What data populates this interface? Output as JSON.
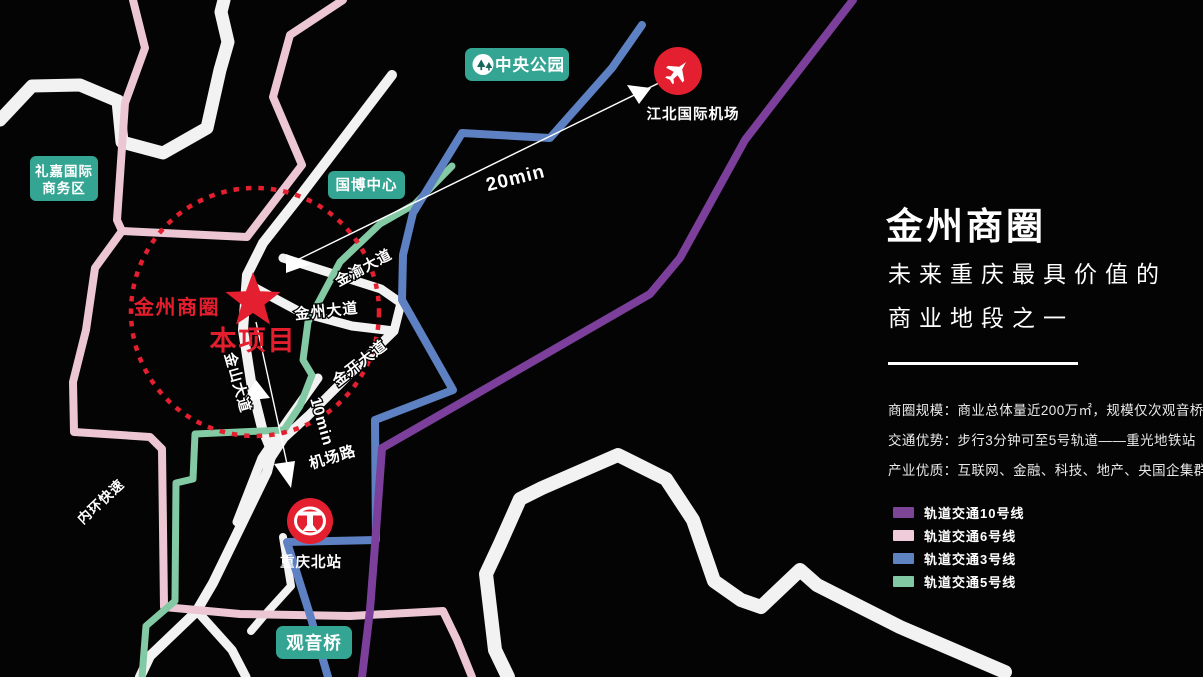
{
  "panel": {
    "title": "金州商圈",
    "subtitle_line1": "未来重庆最具价值的",
    "subtitle_line2": "商业地段之一",
    "desc_line1": "商圈规模：商业总体量近200万㎡，规模仅次观音桥",
    "desc_line2": "交通优势：步行3分钟可至5号轨道——重光地铁站",
    "desc_line3": "产业优质：互联网、金融、科技、地产、央国企集群",
    "legend": [
      {
        "label": "轨道交通10号线",
        "color": "#7d4596"
      },
      {
        "label": "轨道交通6号线",
        "color": "#f0cbd9"
      },
      {
        "label": "轨道交通3号线",
        "color": "#5f83c0"
      },
      {
        "label": "轨道交通5号线",
        "color": "#82c8a2"
      }
    ]
  },
  "map": {
    "poi": {
      "central_park": "中央公园",
      "lijia_line1": "礼嘉国际",
      "lijia_line2": "商务区",
      "expo_center": "国博中心",
      "airport": "江北国际机场",
      "north_station": "重庆北站",
      "guanyinqiao": "观音桥",
      "business_circle": "金州商圈",
      "project": "本项目"
    },
    "roads": {
      "jinyu": "金渝大道",
      "jinzhou": "金州大道",
      "jinkai": "金开大道",
      "jinshan": "金山大道",
      "airport_road": "机场路",
      "inner_ring": "内环快速"
    },
    "times": {
      "to_airport": "20min",
      "to_station": "10min"
    },
    "colors": {
      "line10_purple": "#7c3f9b",
      "line6_pink": "#edc6d4",
      "line3_blue": "#5d81c2",
      "line5_green": "#83c9a3",
      "road_white": "#f2f2f2",
      "poi_teal": "#35a593",
      "accent_red": "#e41f2f",
      "background": "#040404"
    }
  }
}
